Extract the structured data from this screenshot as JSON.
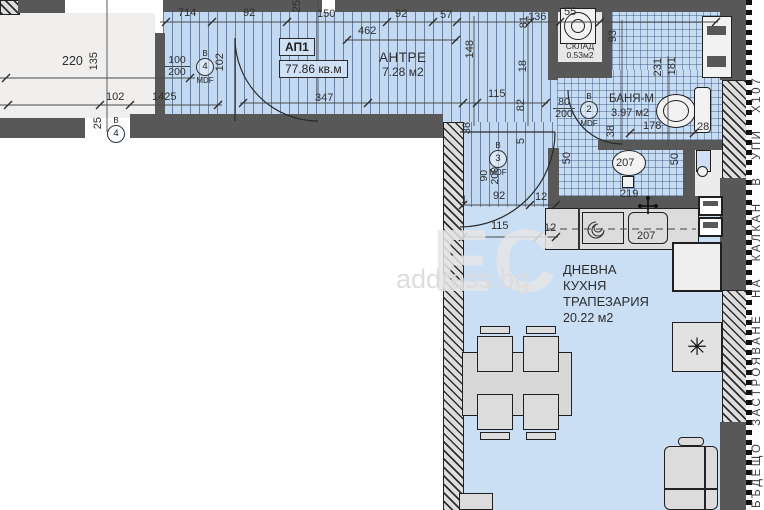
{
  "plan": {
    "apartment": {
      "id": "АП1",
      "area": "77.86 кв.м"
    },
    "rooms": {
      "antre": {
        "name": "АНТРЕ",
        "area": "7.28 м2"
      },
      "sklad": {
        "name": "СКЛАД",
        "area": "0.53м2"
      },
      "banya": {
        "name": "БАНЯ-М",
        "area": "3.97 м2"
      },
      "living": {
        "name1": "ДНЕВНА",
        "name2": "КУХНЯ",
        "name3": "ТРАПЕЗАРИЯ",
        "area": "20.22 м2"
      }
    },
    "doors": {
      "v4": {
        "letter": "В",
        "num": "4",
        "w": "100",
        "h": "200",
        "mat": "MDF"
      },
      "v2": {
        "letter": "В",
        "num": "2",
        "w": "80",
        "h": "200",
        "mat": "MDF"
      },
      "v3": {
        "letter": "В",
        "num": "3",
        "w": "90",
        "h": "200",
        "mat": "MDF"
      },
      "v4b": {
        "letter": "В",
        "num": "4"
      }
    },
    "dims": {
      "top": [
        "714",
        "92",
        "150",
        "462",
        "92",
        "57",
        "136",
        "55"
      ],
      "left": [
        "220",
        "135",
        "102",
        "1425",
        "25",
        "25"
      ],
      "antre": [
        "347",
        "102"
      ],
      "mid": [
        "148",
        "81",
        "18",
        "82",
        "115"
      ],
      "bath": [
        "93",
        "231",
        "181",
        "178",
        "38",
        "28"
      ],
      "niche": [
        "50",
        "207",
        "50"
      ],
      "corr": [
        "38",
        "5",
        "92",
        "12",
        "115",
        "12",
        "1"
      ],
      "kitchen": [
        "219",
        "207"
      ]
    }
  },
  "watermark": {
    "logo": "ЕС",
    "site": "address.bg"
  },
  "margin_note": "БЪДЕЩО ЗАСТРОЯВАНЕ НА КАЛКАН В УПИ Х107",
  "symbols": {
    "fridge": "✳"
  },
  "colors": {
    "floor_blue": "#cadef4",
    "hatch_line": "#26417a",
    "wall": "#585858",
    "furniture": "#dcdcdc",
    "floor_white": "#f0efed"
  }
}
